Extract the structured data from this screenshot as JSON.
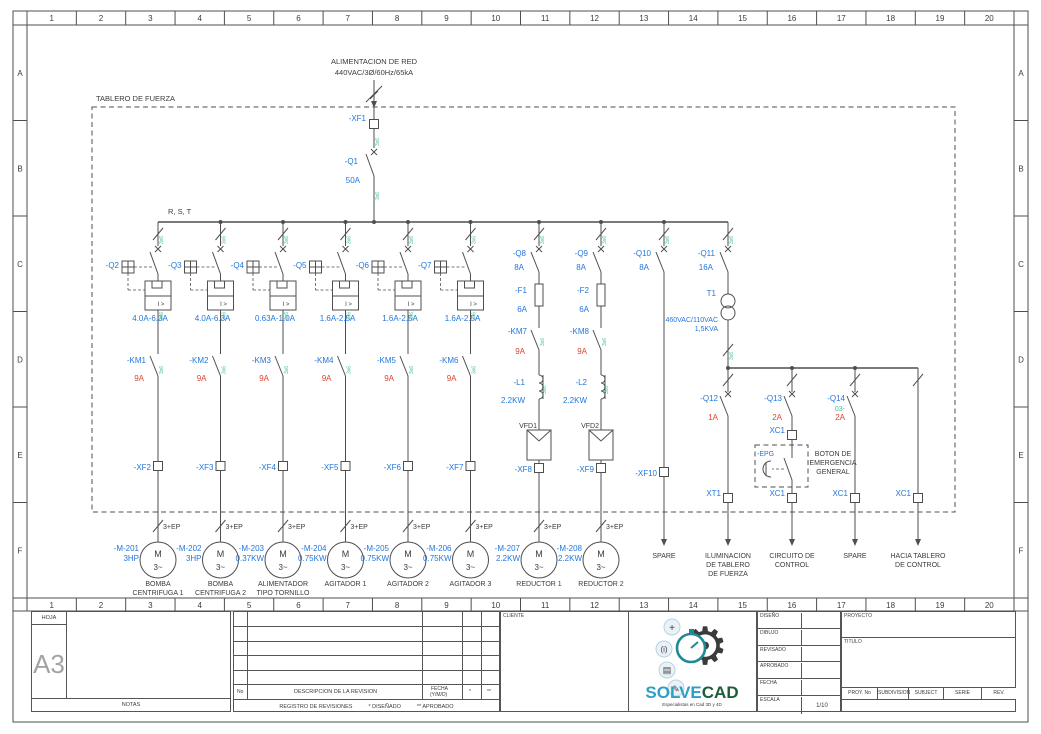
{
  "ruler": {
    "cols": [
      "1",
      "2",
      "3",
      "4",
      "5",
      "6",
      "7",
      "8",
      "9",
      "10",
      "11",
      "12",
      "13",
      "14",
      "15",
      "16",
      "17",
      "18",
      "19",
      "20"
    ],
    "rows": [
      "A",
      "B",
      "C",
      "D",
      "E",
      "F"
    ]
  },
  "supply": {
    "line1": "ALIMENTACION DE RED",
    "line2": "440VAC/3Ø/60Hz/65kA"
  },
  "panel": {
    "label": "TABLERO DE FUERZA",
    "bus": "R, S, T",
    "wire_note": "3x6"
  },
  "incoming": {
    "terminal": "-XF1",
    "breaker": "-Q1",
    "rating": "50A"
  },
  "feeders": [
    {
      "breaker": "-Q2",
      "range": "4.0A-6.3A",
      "contactor": "-KM1",
      "contactor_rating": "9A",
      "terminal": "-XF2",
      "cable": "3+EP",
      "motor_tag": "-M-201",
      "motor_rating": "3HP",
      "load_lines": [
        "BOMBA",
        "CENTRIFUGA 1"
      ]
    },
    {
      "breaker": "-Q3",
      "range": "4.0A-6.3A",
      "contactor": "-KM2",
      "contactor_rating": "9A",
      "terminal": "-XF3",
      "cable": "3+EP",
      "motor_tag": "-M-202",
      "motor_rating": "3HP",
      "load_lines": [
        "BOMBA",
        "CENTRIFUGA 2"
      ]
    },
    {
      "breaker": "-Q4",
      "range": "0.63A-1.0A",
      "contactor": "-KM3",
      "contactor_rating": "9A",
      "terminal": "-XF4",
      "cable": "3+EP",
      "motor_tag": "-M-203",
      "motor_rating": "0.37KW",
      "load_lines": [
        "ALIMENTADOR",
        "TIPO TORNILLO"
      ]
    },
    {
      "breaker": "-Q5",
      "range": "1.6A-2.5A",
      "contactor": "-KM4",
      "contactor_rating": "9A",
      "terminal": "-XF5",
      "cable": "3+EP",
      "motor_tag": "-M-204",
      "motor_rating": "0.75KW",
      "load_lines": [
        "AGITADOR 1"
      ]
    },
    {
      "breaker": "-Q6",
      "range": "1.6A-2.5A",
      "contactor": "-KM5",
      "contactor_rating": "9A",
      "terminal": "-XF6",
      "cable": "3+EP",
      "motor_tag": "-M-205",
      "motor_rating": "0.75KW",
      "load_lines": [
        "AGITADOR 2"
      ]
    },
    {
      "breaker": "-Q7",
      "range": "1.6A-2.5A",
      "contactor": "-KM6",
      "contactor_rating": "9A",
      "terminal": "-XF7",
      "cable": "3+EP",
      "motor_tag": "-M-206",
      "motor_rating": "0.75KW",
      "load_lines": [
        "AGITADOR 3"
      ]
    }
  ],
  "vfds": [
    {
      "breaker": "-Q8",
      "breaker_rating": "8A",
      "fuse": "-F1",
      "fuse_rating": "6A",
      "contactor": "-KM7",
      "contactor_rating": "9A",
      "reactor": "-L1",
      "reactor_rating": "2.2KW",
      "vfd": "VFD1",
      "terminal": "-XF8",
      "cable": "3+EP",
      "motor_tag": "-M-207",
      "motor_rating": "2.2KW",
      "load_lines": [
        "REDUCTOR 1"
      ]
    },
    {
      "breaker": "-Q9",
      "breaker_rating": "8A",
      "fuse": "-F2",
      "fuse_rating": "6A",
      "contactor": "-KM8",
      "contactor_rating": "9A",
      "reactor": "-L2",
      "reactor_rating": "2.2KW",
      "vfd": "VFD2",
      "terminal": "-XF9",
      "cable": "3+EP",
      "motor_tag": "-M-208",
      "motor_rating": "2.2KW",
      "load_lines": [
        "REDUCTOR 2"
      ]
    }
  ],
  "spare": {
    "breaker": "-Q10",
    "rating": "8A",
    "terminal": "-XF10",
    "load_lines": [
      "SPARE"
    ]
  },
  "control": {
    "breaker": "-Q11",
    "rating": "16A",
    "transformer": "T1",
    "tx_spec": "460VAC/110VAC",
    "tx_power": "1,5KVA",
    "branches": [
      {
        "breaker": "-Q12",
        "rating": "1A",
        "terminal": "XT1",
        "load_lines": [
          "ILUMINACION",
          "DE TABLERO",
          "DE FUERZA"
        ]
      },
      {
        "breaker": "-Q13",
        "rating": "2A",
        "terminal_mid": "XC1",
        "button": "-EPG",
        "button_label_lines": [
          "BOTON DE",
          "EMERGENCIA",
          "GENERAL"
        ],
        "terminal": "XC1",
        "load_lines": [
          "CIRCUITO DE",
          "CONTROL"
        ]
      },
      {
        "breaker": "-Q14",
        "wire": "03-",
        "rating": "2A",
        "terminal": "XC1",
        "load_lines": [
          "SPARE"
        ]
      },
      {
        "terminal": "XC1",
        "load_lines": [
          "HACIA TABLERO",
          "DE CONTROL"
        ]
      }
    ]
  },
  "titleblock": {
    "hoja": "HOJA",
    "size": "A3",
    "notas": "NOTAS",
    "rev": {
      "no": "No",
      "desc": "DESCRIPCION DE LA REVISION",
      "fecha": "FECHA",
      "fecha2": "(Y/M/D)",
      "s1": "*",
      "s2": "**",
      "footer": "REGISTRO DE REVISIONES",
      "f1": "* DISEÑADO",
      "f2": "** APROBADO"
    },
    "cliente": "CLIENTE",
    "logo": {
      "part1": "SOLVE",
      "part2": "CAD",
      "tagline": "Especialistas en Cad 3D y 4D"
    },
    "fields": [
      "DISEÑO",
      "DIBUJO",
      "REVISADO",
      "APROBADO",
      "FECHA",
      "ESCALA"
    ],
    "escala_value": "1/10",
    "proyecto": "PROYECTO",
    "titulo": "TITULO",
    "cols": [
      "PROY. No",
      "SUBDIVISION",
      "SUBJECT",
      "SERIE",
      "REV."
    ]
  }
}
